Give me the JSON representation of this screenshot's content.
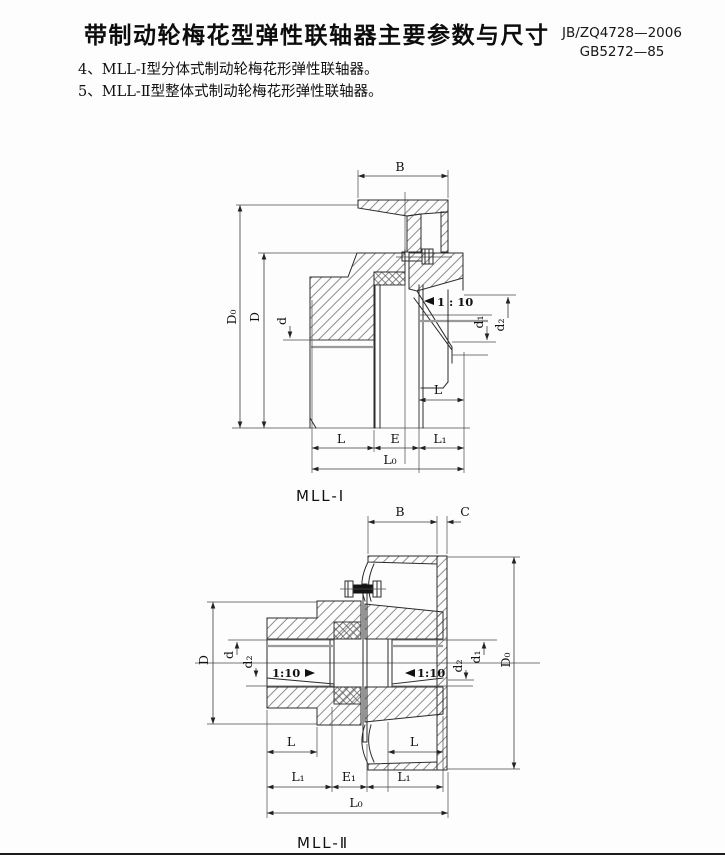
{
  "page": {
    "title": "带制动轮梅花型弹性联轴器主要参数与尺寸",
    "standard_1": "JB/ZQ4728—2006",
    "standard_2": "GB5272—85",
    "note_4": "4、MLL-Ⅰ型分体式制动轮梅花形弹性联轴器。",
    "note_5": "5、MLL-Ⅱ型整体式制动轮梅花形弹性联轴器。"
  },
  "figure1": {
    "caption": "MLL-Ⅰ",
    "labels": {
      "B": "B",
      "D0": "D₀",
      "D": "D",
      "d": "d",
      "d1": "d₁",
      "d2": "d₂",
      "L": "L",
      "E": "E",
      "L1": "L₁",
      "L0": "L₀",
      "taper": "1 : 10"
    }
  },
  "figure2": {
    "caption": "MLL-Ⅱ",
    "labels": {
      "B": "B",
      "C": "C",
      "D0": "D₀",
      "D": "D",
      "d": "d",
      "d1": "d₁",
      "d2": "d₂",
      "L": "L",
      "E1": "E₁",
      "L1": "L₁",
      "L0": "L₀",
      "taper": "1:10"
    }
  },
  "colors": {
    "line": "#2b2b2b",
    "paper": "#fdfdfd",
    "hatch": "#666666"
  }
}
